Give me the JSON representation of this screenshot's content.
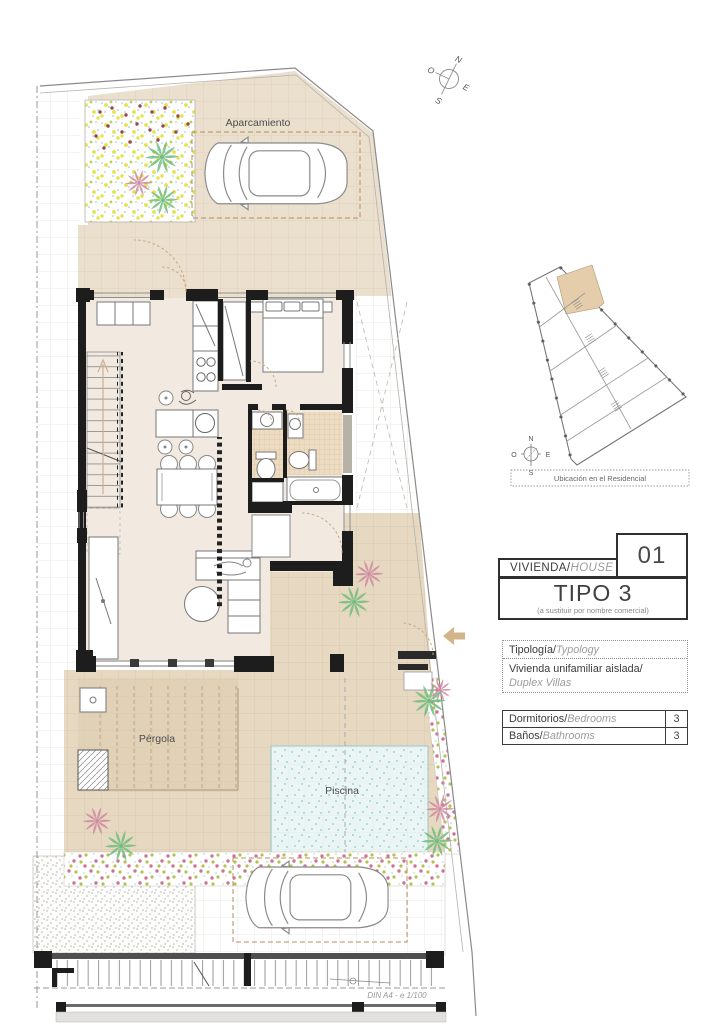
{
  "plan": {
    "area_labels": {
      "parking": "Aparcamiento",
      "pergola": "Pérgola",
      "pool": "Piscina"
    },
    "scale_note": "DIN A4 - e 1/100",
    "compass": {
      "north": "N",
      "south": "S",
      "east": "E",
      "west": "O"
    },
    "location_map": {
      "caption": "Ubicación en el Residencial",
      "compass": {
        "north": "N",
        "south": "S",
        "east": "E",
        "west": "O"
      }
    }
  },
  "panel": {
    "house_label_primary": "VIVIENDA/",
    "house_label_secondary": "HOUSE",
    "house_number": "01",
    "type_title": "TIPO 3",
    "type_subtitle": "(a sustituir por nombre comercial)",
    "typology_heading_primary": "Tipología/",
    "typology_heading_secondary": "Typology",
    "typology_value_primary": "Vivienda unifamiliar aislada/",
    "typology_value_secondary": "Duplex Villas",
    "stats": [
      {
        "label_primary": "Dormitorios/",
        "label_secondary": "Bedrooms",
        "value": "3"
      },
      {
        "label_primary": "Baños/",
        "label_secondary": "Bathrooms",
        "value": "3"
      }
    ]
  },
  "colors": {
    "terrain_beige": "#ebdfce",
    "terrace_beige": "#e7d8c1",
    "interior_floor": "#f2e9e0",
    "pool_blue": "#ebf6f4",
    "palm_green": "#72bd7c",
    "palm_pink": "#cf8aa0",
    "accent_tan_arrow": "#d2b38a",
    "wall_black": "#1d1d1d",
    "line_gray": "#8a8a8a"
  }
}
